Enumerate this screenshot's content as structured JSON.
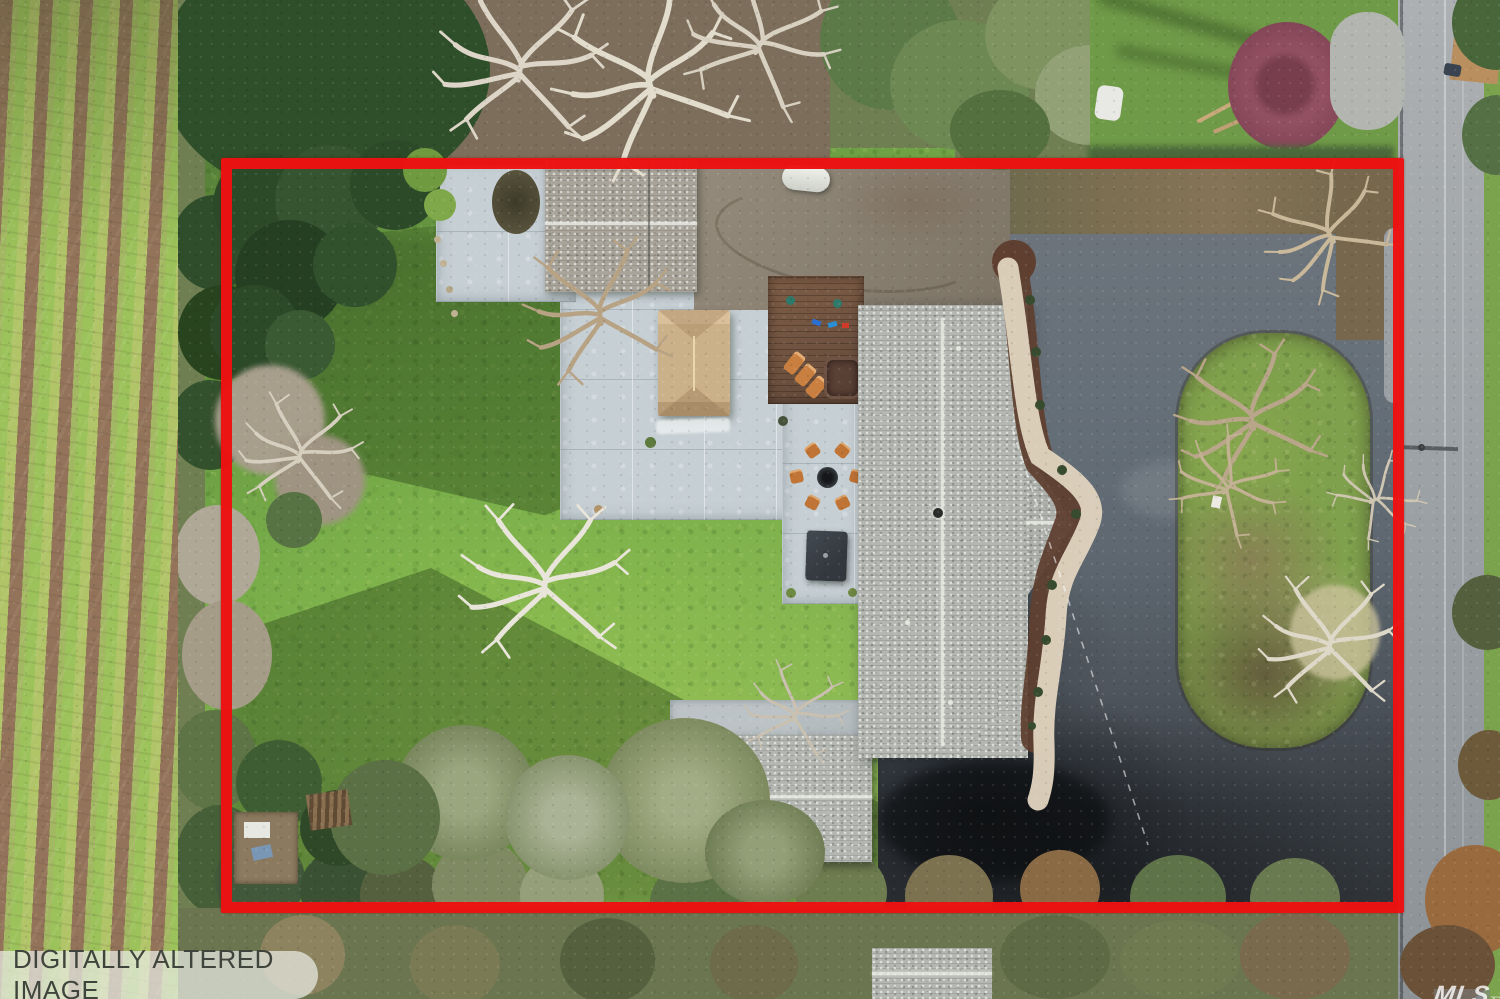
{
  "scene": {
    "title": "aerial-property-photo-with-red-lot-outline",
    "watermark": {
      "text": "DIGITALLY ALTERED IMAGE"
    },
    "logo": {
      "line1": "BAREIS",
      "line2": "MLS"
    },
    "palette": {
      "boundary_red": "#ee1111",
      "lawn_green": "#79a94b",
      "asphalt_gray": "#5c646c",
      "road_gray": "#a2a7aa",
      "concrete_gray": "#c6cfd4",
      "roof_gray": "#b4b7b1",
      "gazebo_tan": "#cbb189",
      "walkway_cream": "#ddd2bd",
      "mulch_brown": "#5f4030",
      "vineyard_green": "#9cc25b",
      "vineyard_brown": "#93745a",
      "conifer_green": "#2c4a28",
      "olive_green": "#98a37b",
      "deck_brown": "#6e5240",
      "maple_purple": "#8a4a5c"
    }
  }
}
